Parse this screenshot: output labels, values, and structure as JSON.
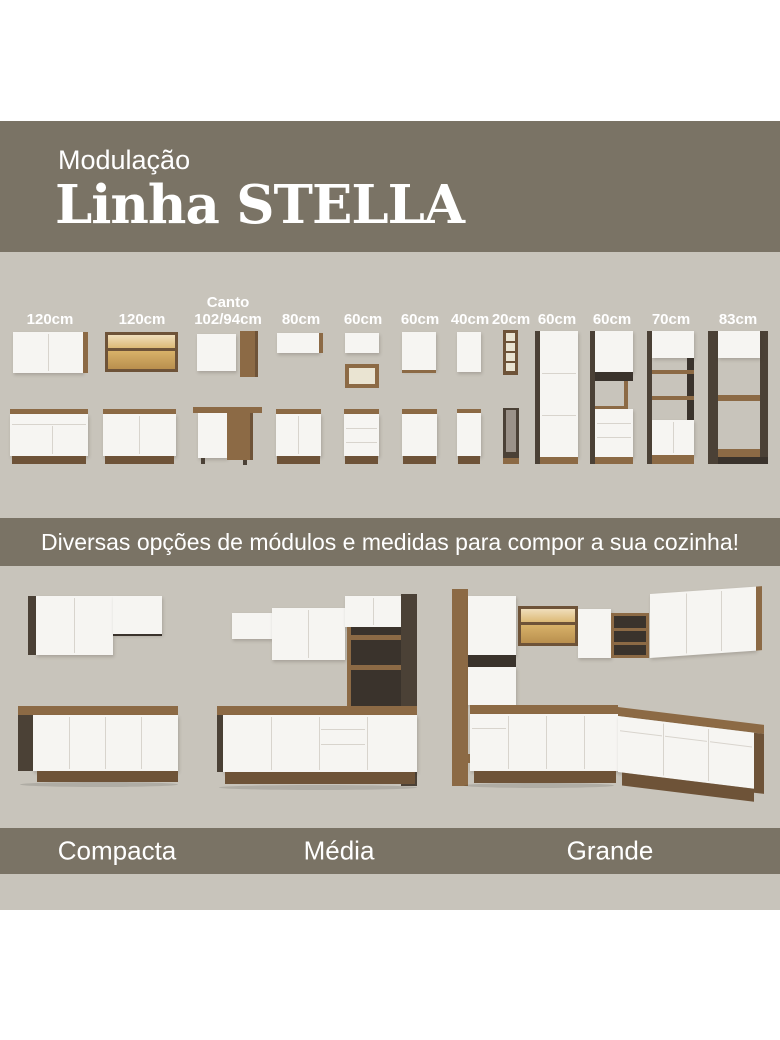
{
  "header": {
    "kicker": "Modulação",
    "title": "Linha STELLA"
  },
  "modules": {
    "labels": [
      {
        "top": "",
        "size": "120cm"
      },
      {
        "top": "",
        "size": "120cm"
      },
      {
        "top": "Canto",
        "size": "102/94cm"
      },
      {
        "top": "",
        "size": "80cm"
      },
      {
        "top": "",
        "size": "60cm"
      },
      {
        "top": "",
        "size": "60cm"
      },
      {
        "top": "",
        "size": "40cm"
      },
      {
        "top": "",
        "size": "20cm"
      },
      {
        "top": "",
        "size": "60cm"
      },
      {
        "top": "",
        "size": "60cm"
      },
      {
        "top": "",
        "size": "70cm"
      },
      {
        "top": "",
        "size": "83cm"
      }
    ]
  },
  "banner": {
    "text": "Diversas opções de módulos e medidas para compor a sua cozinha!"
  },
  "kitchens": [
    {
      "label": "Compacta"
    },
    {
      "label": "Média"
    },
    {
      "label": "Grande"
    }
  ],
  "colors": {
    "band": "#7a7365",
    "background": "#c8c4bb",
    "wood": "#8c6a45",
    "wood_dark": "#6e5338",
    "panel_dark": "#4b4136",
    "front_white": "#f6f5f2",
    "glass_amber": "#d9b36a"
  }
}
